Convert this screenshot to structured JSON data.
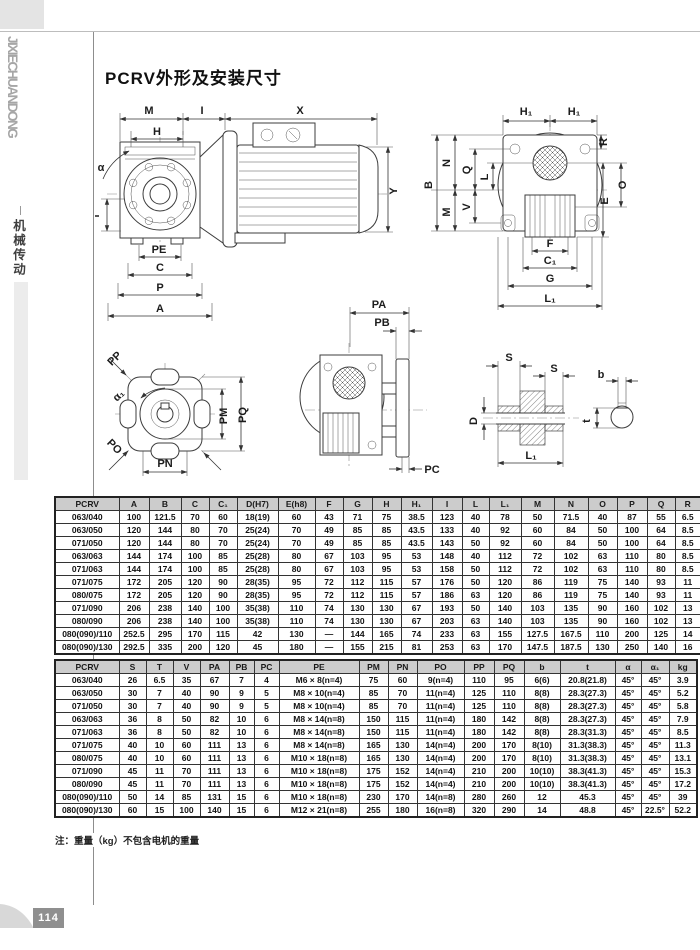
{
  "sidebar": {
    "brand_vertical": "JIXIECHUANDONG",
    "category_vertical": "机械传动",
    "page_number": "114"
  },
  "page": {
    "title": "PCRV外形及安装尺寸",
    "note": "注：重量（kg）不包含电机的重量"
  },
  "diagrams": {
    "front_view": {
      "labels": {
        "M": "M",
        "I": "I",
        "X": "X",
        "H": "H",
        "alpha": "α",
        "T": "T",
        "Y": "Y",
        "PE": "PE",
        "C": "C",
        "P": "P",
        "A": "A"
      }
    },
    "side_view": {
      "labels": {
        "H1_left": "H₁",
        "H1_right": "H₁",
        "B": "B",
        "N": "N",
        "M": "M",
        "Q": "Q",
        "V": "V",
        "L": "L",
        "R": "R",
        "E": "E",
        "O": "O",
        "F": "F",
        "C1": "C₁",
        "G": "G",
        "L1": "L₁"
      }
    },
    "mount_flange": {
      "labels": {
        "PP": "PP",
        "alpha1": "α₁",
        "PO": "PO",
        "PN": "PN",
        "PM": "PM",
        "PQ": "PQ"
      }
    },
    "output_side": {
      "labels": {
        "PA": "PA",
        "PB": "PB",
        "PC": "PC"
      }
    },
    "hollow_shaft": {
      "labels": {
        "S_left": "S",
        "S_right": "S",
        "D": "D",
        "L1": "L₁",
        "b": "b",
        "t": "t"
      }
    }
  },
  "tables": {
    "dim1": {
      "headers": [
        "PCRV",
        "A",
        "B",
        "C",
        "C₁",
        "D(H7)",
        "E(h8)",
        "F",
        "G",
        "H",
        "H₁",
        "I",
        "L",
        "L₁",
        "M",
        "N",
        "O",
        "P",
        "Q",
        "R"
      ],
      "rows": [
        [
          "063/040",
          "100",
          "121.5",
          "70",
          "60",
          "18(19)",
          "60",
          "43",
          "71",
          "75",
          "38.5",
          "123",
          "40",
          "78",
          "50",
          "71.5",
          "40",
          "87",
          "55",
          "6.5"
        ],
        [
          "063/050",
          "120",
          "144",
          "80",
          "70",
          "25(24)",
          "70",
          "49",
          "85",
          "85",
          "43.5",
          "133",
          "40",
          "92",
          "60",
          "84",
          "50",
          "100",
          "64",
          "8.5"
        ],
        [
          "071/050",
          "120",
          "144",
          "80",
          "70",
          "25(24)",
          "70",
          "49",
          "85",
          "85",
          "43.5",
          "143",
          "50",
          "92",
          "60",
          "84",
          "50",
          "100",
          "64",
          "8.5"
        ],
        [
          "063/063",
          "144",
          "174",
          "100",
          "85",
          "25(28)",
          "80",
          "67",
          "103",
          "95",
          "53",
          "148",
          "40",
          "112",
          "72",
          "102",
          "63",
          "110",
          "80",
          "8.5"
        ],
        [
          "071/063",
          "144",
          "174",
          "100",
          "85",
          "25(28)",
          "80",
          "67",
          "103",
          "95",
          "53",
          "158",
          "50",
          "112",
          "72",
          "102",
          "63",
          "110",
          "80",
          "8.5"
        ],
        [
          "071/075",
          "172",
          "205",
          "120",
          "90",
          "28(35)",
          "95",
          "72",
          "112",
          "115",
          "57",
          "176",
          "50",
          "120",
          "86",
          "119",
          "75",
          "140",
          "93",
          "11"
        ],
        [
          "080/075",
          "172",
          "205",
          "120",
          "90",
          "28(35)",
          "95",
          "72",
          "112",
          "115",
          "57",
          "186",
          "63",
          "120",
          "86",
          "119",
          "75",
          "140",
          "93",
          "11"
        ],
        [
          "071/090",
          "206",
          "238",
          "140",
          "100",
          "35(38)",
          "110",
          "74",
          "130",
          "130",
          "67",
          "193",
          "50",
          "140",
          "103",
          "135",
          "90",
          "160",
          "102",
          "13"
        ],
        [
          "080/090",
          "206",
          "238",
          "140",
          "100",
          "35(38)",
          "110",
          "74",
          "130",
          "130",
          "67",
          "203",
          "63",
          "140",
          "103",
          "135",
          "90",
          "160",
          "102",
          "13"
        ],
        [
          "080(090)/110",
          "252.5",
          "295",
          "170",
          "115",
          "42",
          "130",
          "—",
          "144",
          "165",
          "74",
          "233",
          "63",
          "155",
          "127.5",
          "167.5",
          "110",
          "200",
          "125",
          "14"
        ],
        [
          "080(090)/130",
          "292.5",
          "335",
          "200",
          "120",
          "45",
          "180",
          "—",
          "155",
          "215",
          "81",
          "253",
          "63",
          "170",
          "147.5",
          "187.5",
          "130",
          "250",
          "140",
          "16"
        ]
      ]
    },
    "dim2": {
      "headers": [
        "PCRV",
        "S",
        "T",
        "V",
        "PA",
        "PB",
        "PC",
        "PE",
        "PM",
        "PN",
        "PO",
        "PP",
        "PQ",
        "b",
        "t",
        "α",
        "α₁",
        "kg"
      ],
      "rows": [
        [
          "063/040",
          "26",
          "6.5",
          "35",
          "67",
          "7",
          "4",
          "M6 × 8(n=4)",
          "75",
          "60",
          "9(n=4)",
          "110",
          "95",
          "6(6)",
          "20.8(21.8)",
          "45°",
          "45°",
          "3.9"
        ],
        [
          "063/050",
          "30",
          "7",
          "40",
          "90",
          "9",
          "5",
          "M8 × 10(n=4)",
          "85",
          "70",
          "11(n=4)",
          "125",
          "110",
          "8(8)",
          "28.3(27.3)",
          "45°",
          "45°",
          "5.2"
        ],
        [
          "071/050",
          "30",
          "7",
          "40",
          "90",
          "9",
          "5",
          "M8 × 10(n=4)",
          "85",
          "70",
          "11(n=4)",
          "125",
          "110",
          "8(8)",
          "28.3(27.3)",
          "45°",
          "45°",
          "5.8"
        ],
        [
          "063/063",
          "36",
          "8",
          "50",
          "82",
          "10",
          "6",
          "M8 × 14(n=8)",
          "150",
          "115",
          "11(n=4)",
          "180",
          "142",
          "8(8)",
          "28.3(27.3)",
          "45°",
          "45°",
          "7.9"
        ],
        [
          "071/063",
          "36",
          "8",
          "50",
          "82",
          "10",
          "6",
          "M8 × 14(n=8)",
          "150",
          "115",
          "11(n=4)",
          "180",
          "142",
          "8(8)",
          "28.3(31.3)",
          "45°",
          "45°",
          "8.5"
        ],
        [
          "071/075",
          "40",
          "10",
          "60",
          "111",
          "13",
          "6",
          "M8 × 14(n=8)",
          "165",
          "130",
          "14(n=4)",
          "200",
          "170",
          "8(10)",
          "31.3(38.3)",
          "45°",
          "45°",
          "11.3"
        ],
        [
          "080/075",
          "40",
          "10",
          "60",
          "111",
          "13",
          "6",
          "M10 × 18(n=8)",
          "165",
          "130",
          "14(n=4)",
          "200",
          "170",
          "8(10)",
          "31.3(38.3)",
          "45°",
          "45°",
          "13.1"
        ],
        [
          "071/090",
          "45",
          "11",
          "70",
          "111",
          "13",
          "6",
          "M10 × 18(n=8)",
          "175",
          "152",
          "14(n=4)",
          "210",
          "200",
          "10(10)",
          "38.3(41.3)",
          "45°",
          "45°",
          "15.3"
        ],
        [
          "080/090",
          "45",
          "11",
          "70",
          "111",
          "13",
          "6",
          "M10 × 18(n=8)",
          "175",
          "152",
          "14(n=4)",
          "210",
          "200",
          "10(10)",
          "38.3(41.3)",
          "45°",
          "45°",
          "17.2"
        ],
        [
          "080(090)/110",
          "50",
          "14",
          "85",
          "131",
          "15",
          "6",
          "M10 × 18(n=8)",
          "230",
          "170",
          "14(n=8)",
          "280",
          "260",
          "12",
          "45.3",
          "45°",
          "45°",
          "39"
        ],
        [
          "080(090)/130",
          "60",
          "15",
          "100",
          "140",
          "15",
          "6",
          "M12 × 21(n=8)",
          "255",
          "180",
          "16(n=8)",
          "320",
          "290",
          "14",
          "48.8",
          "45°",
          "22.5°",
          "52.2"
        ]
      ]
    }
  }
}
